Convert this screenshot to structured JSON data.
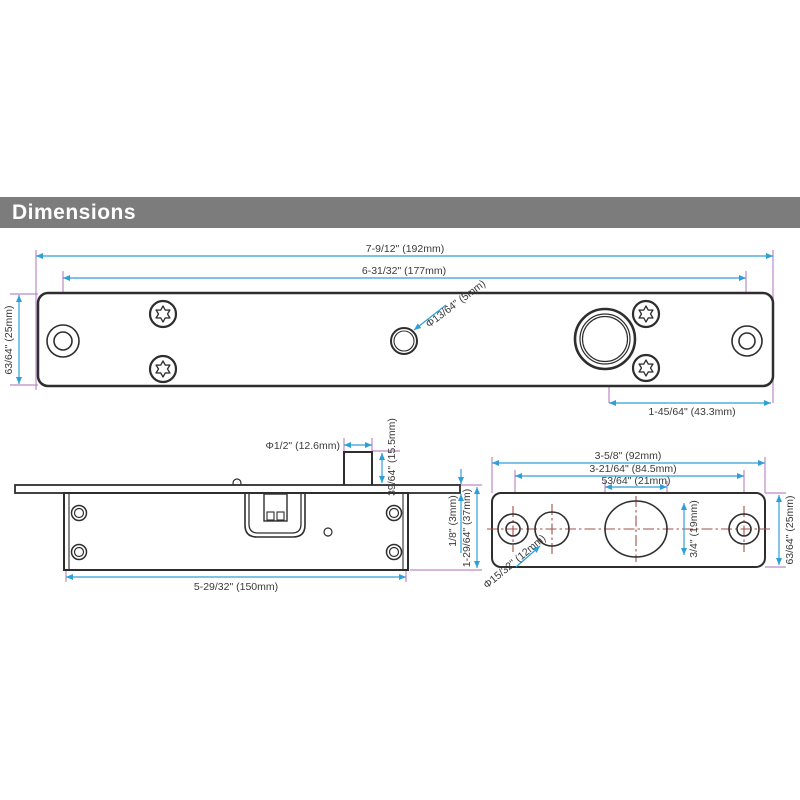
{
  "header": {
    "title": "Dimensions"
  },
  "colors": {
    "header_bg": "#7c7c7c",
    "dimension_line": "#2e9fd8",
    "extension_line": "#bd89c7",
    "centerline": "#a34f4a",
    "outline": "#2e2e2e"
  },
  "top_view": {
    "dims": {
      "overall_width": "7-9/12\" (192mm)",
      "hole_spacing": "6-31/32\" (177mm)",
      "height": "63/64\" (25mm)",
      "small_hole_dia": "Φ13/64\" (5mm)",
      "bolt_offset": "1-45/64\" (43.3mm)"
    }
  },
  "side_view": {
    "dims": {
      "bolt_dia": "Φ1/2\" (12.6mm)",
      "bolt_throw": "39/64\" (15.5mm)",
      "plate_thickness": "1/8\" (3mm)",
      "body_depth": "1-29/64\" (37mm)",
      "body_length": "5-29/32\" (150mm)"
    }
  },
  "end_view": {
    "dims": {
      "overall_width": "3-5/8\" (92mm)",
      "hole_spacing": "3-21/64\" (84.5mm)",
      "bolt_hole_width": "53/64\" (21mm)",
      "bolt_hole_height": "3/4\" (19mm)",
      "height": "63/64\" (25mm)",
      "guide_hole_dia": "Φ15/32\" (12mm)"
    }
  }
}
